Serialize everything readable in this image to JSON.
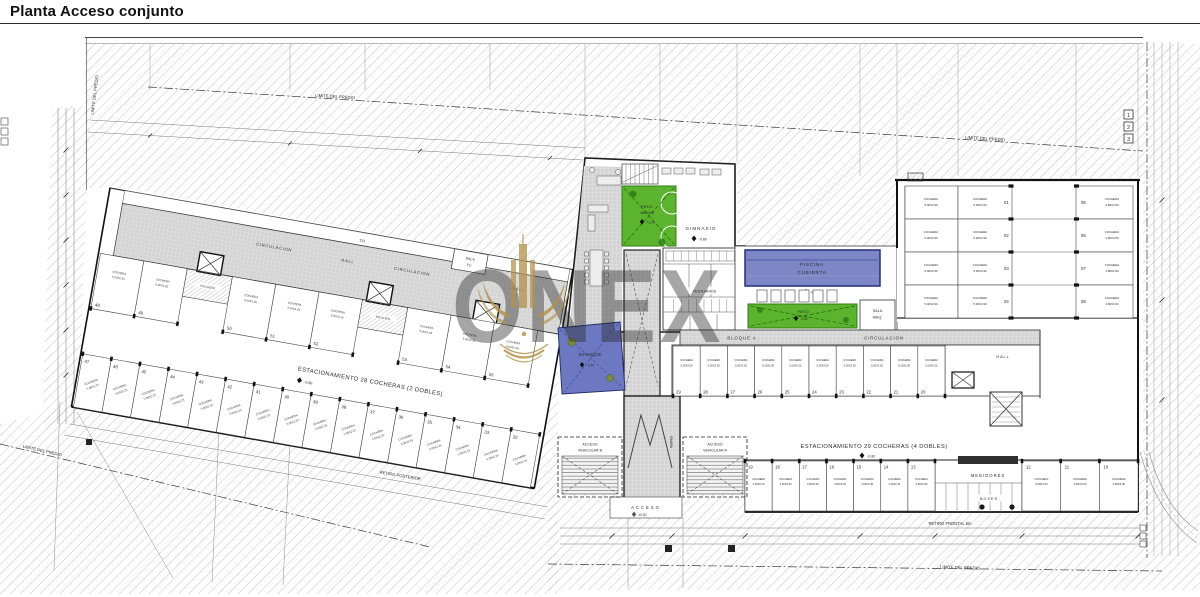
{
  "title": "Planta Acceso conjunto",
  "watermark": {
    "brand": "ONEX"
  },
  "site": {
    "property_line": "LIMITE DEL PREDIO",
    "retiro_posterior": "RETIRO POSTERIOR",
    "retiro_frontal": "RETIRO FRONTAL 5m",
    "grid_markers": [
      "1",
      "2",
      "3"
    ]
  },
  "left_block": {
    "terrace": "T.R.",
    "circulation_1": "CIRCULACION",
    "hall_1": "HALL",
    "circulation_2": "CIRCULACION",
    "hall_2": "HALL",
    "sala_line1": "SALA",
    "sala_line2": "TV",
    "escalera": "ESCALERA",
    "aisle": {
      "label": "ESTACIONAMIENTO 28 COCHERAS (2 DOBLES)",
      "elevation": "-0.80"
    },
    "stall": {
      "name": "COCHERA",
      "dim": "5.00X2.25"
    },
    "row_top_numbers": [
      "48",
      "49",
      "50",
      "51",
      "52",
      "53",
      "54",
      "55"
    ],
    "row_bottom_numbers": [
      "47",
      "46",
      "45",
      "44",
      "43",
      "42",
      "41",
      "40",
      "39",
      "38",
      "37",
      "36",
      "35",
      "34",
      "33",
      "32"
    ]
  },
  "tower": {
    "patio_jardin": {
      "line1": "PATIO",
      "line2": "JARDIN",
      "elevation": "+1.20"
    },
    "gimnasio": {
      "label": "GIMNASIO",
      "elevation": "-0.80"
    },
    "vestuarios": "VESTUARIOS",
    "estanque": {
      "label": "ESTANQUE",
      "elevation": "-1.00"
    },
    "rampa": "RAMPA",
    "acceso": {
      "label": "ACCESO",
      "elevation": "±0.00"
    }
  },
  "amenities": {
    "piscina": {
      "line1": "PISCINA",
      "line2": "CUBIERTA",
      "elevation": "-0.80"
    },
    "patio": {
      "label": "PATIO",
      "elevation": "-0.80"
    },
    "sala_maquinas": {
      "line1": "SALA",
      "line2": "MAQ."
    }
  },
  "right_block": {
    "bloque": "BLOQUE A",
    "circulation": "CIRCULACION",
    "hall": "HALL",
    "aisle": {
      "label": "ESTACIONAMIENTO 29 COCHERAS (4 DOBLES)",
      "elevation": "-0.80"
    },
    "medidores": "MEDIDORES",
    "boxes": "BOXES",
    "stall_name": "COCHERA",
    "grid": {
      "col1_dim": "5.00X2.90",
      "col2_dim": "5.00X2.90",
      "col3_dim": "4.80X2.90",
      "col2_numbers": [
        "01",
        "02",
        "03",
        "04"
      ],
      "col3_numbers": [
        "05",
        "06",
        "07",
        "08"
      ]
    },
    "row_mid": {
      "dim": "5.00X2.50",
      "numbers": [
        "29",
        "28",
        "27",
        "26",
        "25",
        "24",
        "23",
        "22",
        "21",
        "20"
      ]
    },
    "row_bottom_a": {
      "dim": "4.60X2.40",
      "numbers": [
        "19",
        "18",
        "17",
        "16",
        "15",
        "14",
        "13"
      ]
    },
    "row_bottom_b": {
      "dim": "4.60X3.00",
      "numbers": [
        "12",
        "11",
        "10"
      ]
    }
  },
  "accesses": {
    "vehicular_b": {
      "line1": "ACCESO",
      "line2": "VEHICULAR B"
    },
    "vehicular_a": {
      "line1": "ACCESO",
      "line2": "VEHICULAR A"
    }
  }
}
